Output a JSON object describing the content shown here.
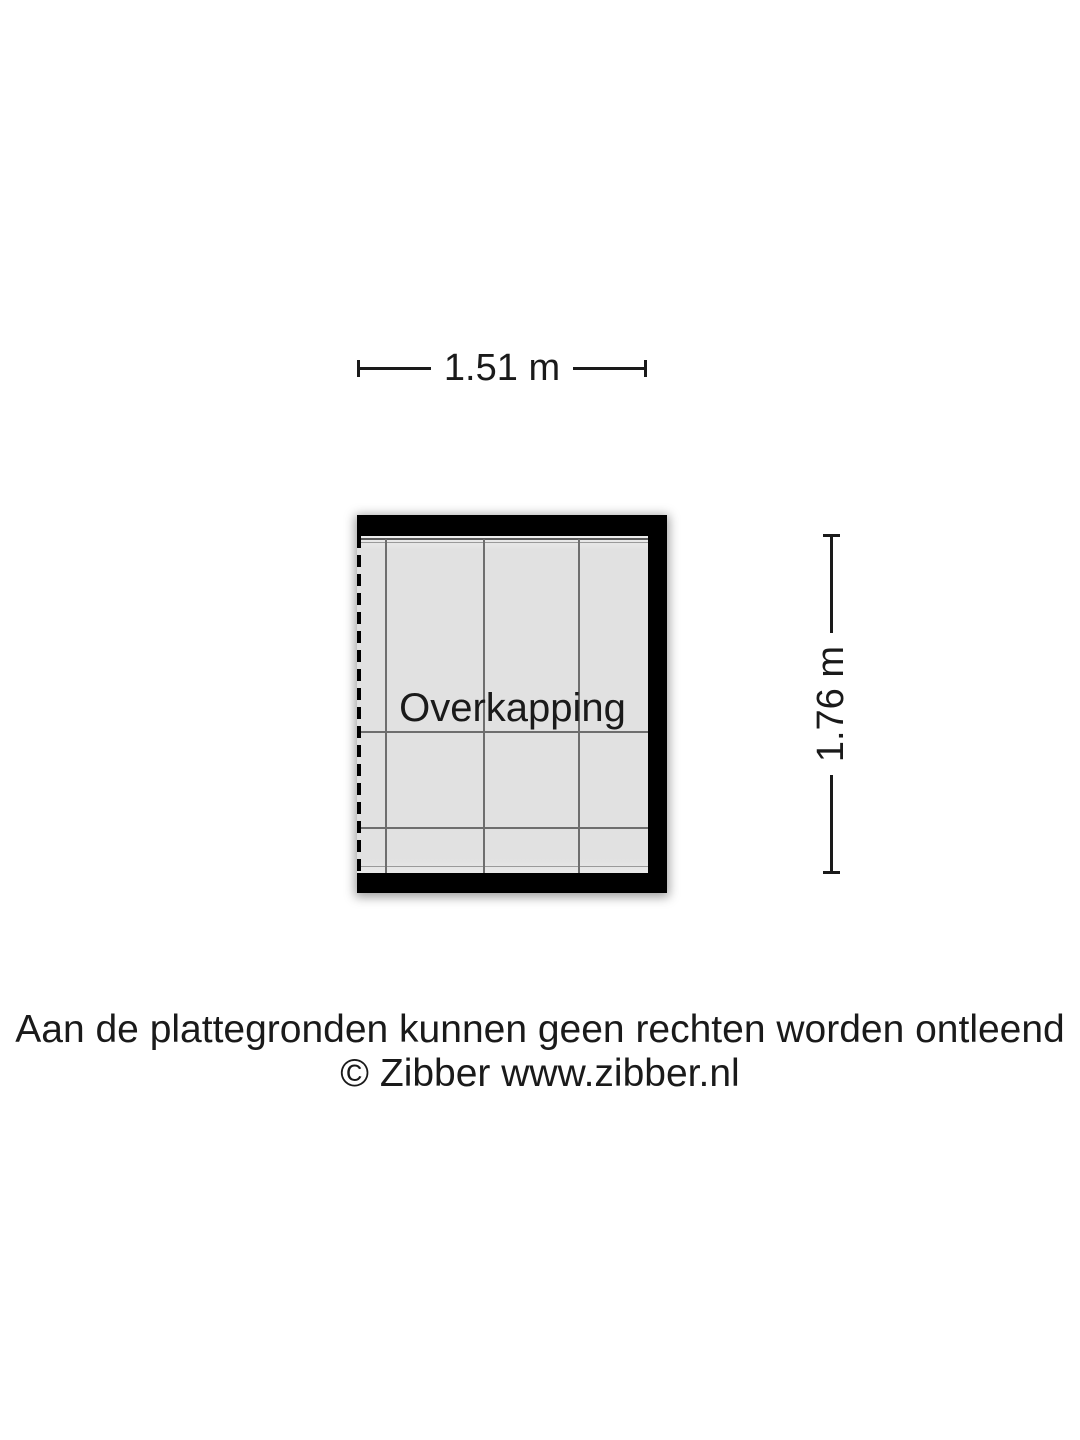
{
  "floorplan": {
    "room_label": "Overkapping",
    "width_dimension": "1.51 m",
    "height_dimension": "1.76 m"
  },
  "footer": {
    "disclaimer": "Aan de plattegronden kunnen geen rechten worden ontleend",
    "copyright": "© Zibber www.zibber.nl"
  },
  "colors": {
    "background": "#ffffff",
    "wall": "#000000",
    "floor": "#e1e1e1",
    "grid_line": "#6e6e6e",
    "text": "#1a1a1a"
  }
}
